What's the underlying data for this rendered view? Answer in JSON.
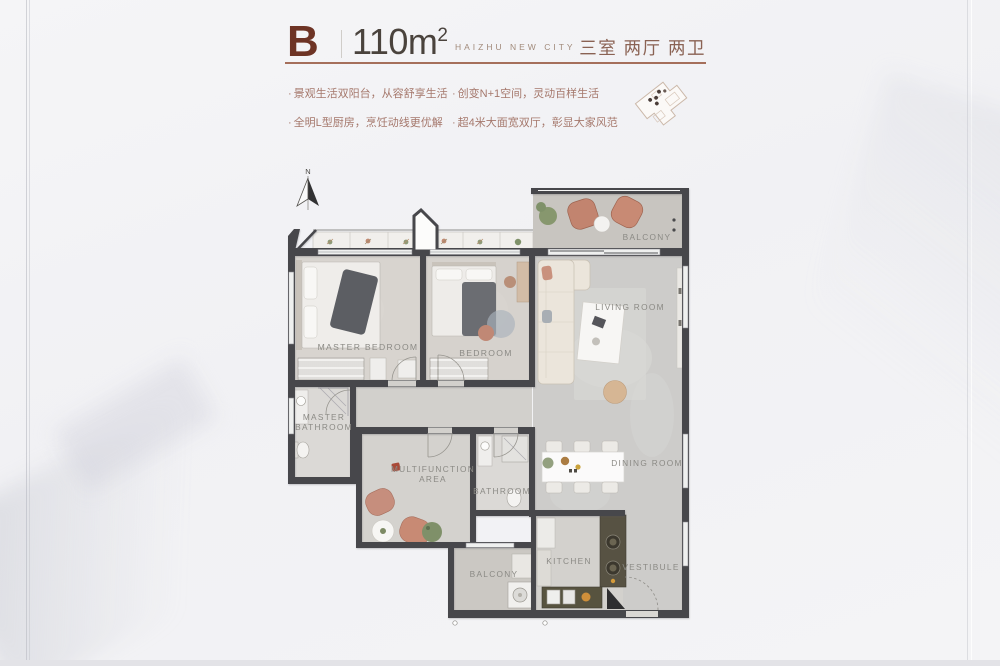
{
  "header": {
    "unit_label": "B",
    "area_value": "110m",
    "area_superscript": "2",
    "project_name": "HAIZHU NEW CITY",
    "layout_summary": "三室 两厅 两卫"
  },
  "features": {
    "bullet": "·",
    "items": [
      "景观生活双阳台，从容舒享生活",
      "全明L型厨房，烹饪动线更优解",
      "创变N+1空间，灵动百样生活",
      "超4米大面宽双厅，彰显大家风范"
    ]
  },
  "floorplan": {
    "north_label": "N",
    "labels": {
      "balcony_top": "BALCONY",
      "living_room": "LIVING ROOM",
      "master_bedroom": "MASTER BEDROOM",
      "bedroom": "BEDROOM",
      "master_bathroom_line1": "MASTER",
      "master_bathroom_line2": "BATHROOM",
      "multifunction_line1": "MULTIFUNCTION",
      "multifunction_line2": "AREA",
      "bathroom": "BATHROOM",
      "dining_room": "DINING ROOM",
      "kitchen": "KITCHEN",
      "vestibule": "VESTIBULE",
      "balcony_bottom": "BALCONY"
    }
  },
  "colors": {
    "accent_dark_red": "#6e3425",
    "header_rule": "#a56f5b",
    "feature_text": "#a5786c",
    "wall": "#46474b",
    "room_label": "#8b8a85",
    "salmon_furniture": "#c2846f",
    "kitchen_counter": "#575243"
  }
}
